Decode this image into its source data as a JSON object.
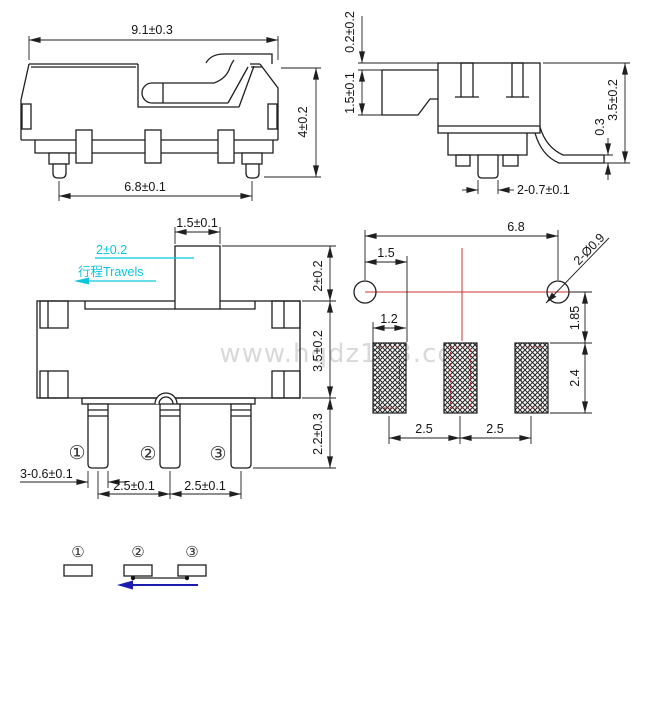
{
  "watermark": {
    "text": "www.hqdz123.com"
  },
  "colors": {
    "line": "#1f1f1f",
    "cyan": "#0cc6de",
    "red_centerline": "#cc3333",
    "pad_inner_red": "#9c3434",
    "blue_arrow": "#1c1cb0",
    "watermark_gray": "#d9d9d9"
  },
  "top_view": {
    "dim_width": "9.1±0.3",
    "dim_height": "4±0.2",
    "dim_feet_span": "6.8±0.1"
  },
  "side_view": {
    "dim_top_gap": "0.2±0.2",
    "dim_lever_height": "1.5±0.1",
    "dim_body_height": "3.5±0.2",
    "dim_foot_thickness": "0.3",
    "dim_pin_width": "2-0.7±0.1"
  },
  "front_view": {
    "dim_actuator_width": "1.5±0.1",
    "travel_value": "2±0.2",
    "travel_label": "行程Travels",
    "dim_actuator_height": "2±0.2",
    "dim_body_height": "3.5±0.2",
    "dim_pin_length": "2.2±0.3",
    "dim_pin_width": "3-0.6±0.1",
    "dim_pitch_left": "2.5±0.1",
    "dim_pitch_right": "2.5±0.1",
    "pin_labels": [
      "①",
      "②",
      "③"
    ]
  },
  "pcb_layout": {
    "dim_hole_span": "6.8",
    "dim_hole_to_pad": "1.5",
    "dim_holes": "2-Ø0.9",
    "dim_pad_offset": "1.85",
    "dim_pad_width": "1.2",
    "dim_pad_height": "2.4",
    "dim_pitch_left": "2.5",
    "dim_pitch_right": "2.5"
  },
  "schematic": {
    "pin_labels": [
      "①",
      "②",
      "③"
    ]
  }
}
